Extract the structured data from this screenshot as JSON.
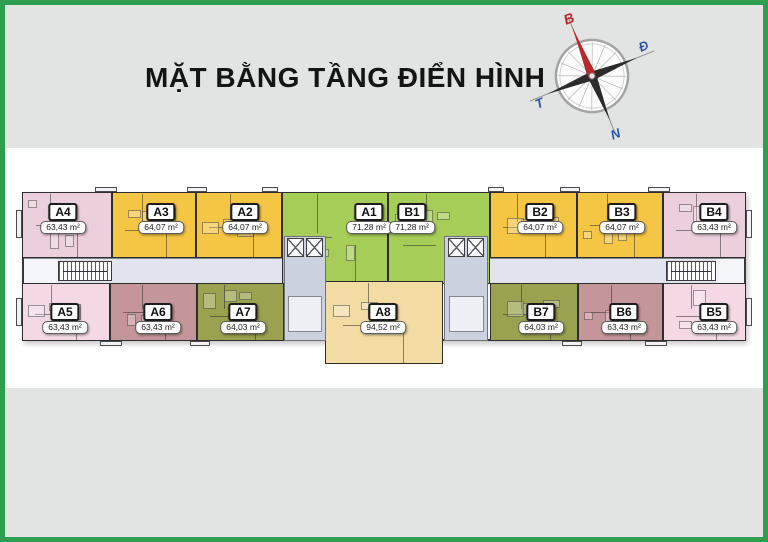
{
  "title": "MẶT BẰNG TẦNG ĐIỂN HÌNH",
  "compass": {
    "north": "B",
    "east": "Đ",
    "south": "N",
    "west": "T",
    "north_color": "#c0272d",
    "dir_color": "#2a55a5"
  },
  "palette": {
    "frame": "#2e9e50",
    "canvas": "#e2e4e3",
    "band": "#ffffff",
    "wall": "#383838",
    "yellow": "#f5c544",
    "green": "#a6cd58",
    "pink_top": "#ebcfdc",
    "pink_bottom": "#f4d9e4",
    "mauve": "#c49599",
    "olive": "#9aa14f",
    "tan": "#f3dba4",
    "corridor": "#e2e5f0",
    "core": "#ccd1df"
  },
  "floorplan": {
    "building": {
      "x": 22,
      "y": 192,
      "w": 724,
      "h": 149
    },
    "units": [
      {
        "code": "A4",
        "area": "63,43 m²",
        "color": "pink_top",
        "x": 22,
        "y": 192,
        "w": 90,
        "h": 66,
        "lx": 63,
        "row": "top"
      },
      {
        "code": "A3",
        "area": "64,07 m²",
        "color": "yellow",
        "x": 112,
        "y": 192,
        "w": 84,
        "h": 66,
        "lx": 161,
        "row": "top"
      },
      {
        "code": "A2",
        "area": "64,07 m²",
        "color": "yellow",
        "x": 196,
        "y": 192,
        "w": 86,
        "h": 66,
        "lx": 245,
        "row": "top"
      },
      {
        "code": "A1",
        "area": "71,28 m²",
        "color": "green",
        "x": 282,
        "y": 192,
        "w": 106,
        "h": 92,
        "lx": 369,
        "row": "top"
      },
      {
        "code": "B1",
        "area": "71,28 m²",
        "color": "green",
        "x": 388,
        "y": 192,
        "w": 102,
        "h": 92,
        "lx": 412,
        "row": "top"
      },
      {
        "code": "B2",
        "area": "64,07 m²",
        "color": "yellow",
        "x": 490,
        "y": 192,
        "w": 87,
        "h": 66,
        "lx": 540,
        "row": "top"
      },
      {
        "code": "B3",
        "area": "64,07 m²",
        "color": "yellow",
        "x": 577,
        "y": 192,
        "w": 86,
        "h": 66,
        "lx": 622,
        "row": "top"
      },
      {
        "code": "B4",
        "area": "63,43 m²",
        "color": "pink_top",
        "x": 663,
        "y": 192,
        "w": 83,
        "h": 66,
        "lx": 714,
        "row": "top"
      },
      {
        "code": "A5",
        "area": "63,43 m²",
        "color": "pink_bottom",
        "x": 22,
        "y": 283,
        "w": 88,
        "h": 58,
        "lx": 65,
        "row": "bottom"
      },
      {
        "code": "A6",
        "area": "63,43 m²",
        "color": "mauve",
        "x": 110,
        "y": 283,
        "w": 87,
        "h": 58,
        "lx": 158,
        "row": "bottom"
      },
      {
        "code": "A7",
        "area": "64,03 m²",
        "color": "olive",
        "x": 197,
        "y": 283,
        "w": 87,
        "h": 58,
        "lx": 243,
        "row": "bottom"
      },
      {
        "code": "B7",
        "area": "64,03 m²",
        "color": "olive",
        "x": 490,
        "y": 283,
        "w": 88,
        "h": 58,
        "lx": 541,
        "row": "bottom"
      },
      {
        "code": "B6",
        "area": "63,43 m²",
        "color": "mauve",
        "x": 578,
        "y": 283,
        "w": 85,
        "h": 58,
        "lx": 624,
        "row": "bottom"
      },
      {
        "code": "B5",
        "area": "63,43 m²",
        "color": "pink_bottom",
        "x": 663,
        "y": 283,
        "w": 83,
        "h": 58,
        "lx": 714,
        "row": "bottom"
      },
      {
        "code": "A8",
        "area": "94,52 m²",
        "color": "tan",
        "x": 325,
        "y": 281,
        "w": 118,
        "h": 83,
        "lx": 383,
        "row": "bottom"
      }
    ],
    "label_rows": {
      "top": {
        "code_y": 203,
        "area_y": 221
      },
      "bottom": {
        "code_y": 303,
        "area_y": 321
      }
    },
    "corridors": [
      {
        "x": 24,
        "y": 258,
        "w": 260,
        "h": 26
      },
      {
        "x": 488,
        "y": 258,
        "w": 256,
        "h": 26
      }
    ],
    "endcaps": [
      {
        "x": 24,
        "y": 259,
        "w": 34,
        "h": 24
      },
      {
        "x": 716,
        "y": 259,
        "w": 28,
        "h": 24
      }
    ],
    "stairs": [
      {
        "x": 58,
        "y": 261,
        "w": 54,
        "h": 20
      },
      {
        "x": 666,
        "y": 261,
        "w": 50,
        "h": 20
      }
    ],
    "lobbies": [
      {
        "x": 284,
        "y": 236,
        "w": 42,
        "h": 105
      },
      {
        "x": 444,
        "y": 236,
        "w": 44,
        "h": 105
      }
    ],
    "shafts": [
      {
        "x": 287,
        "y": 238,
        "w": 17,
        "h": 19
      },
      {
        "x": 306,
        "y": 238,
        "w": 17,
        "h": 19
      },
      {
        "x": 448,
        "y": 238,
        "w": 17,
        "h": 19
      },
      {
        "x": 467,
        "y": 238,
        "w": 17,
        "h": 19
      }
    ],
    "lobby_rooms": [
      {
        "x": 288,
        "y": 296,
        "w": 34,
        "h": 36
      },
      {
        "x": 449,
        "y": 296,
        "w": 35,
        "h": 36
      }
    ],
    "balconies": [
      {
        "x": 95,
        "y": 187,
        "w": 22,
        "h": 5
      },
      {
        "x": 187,
        "y": 187,
        "w": 20,
        "h": 5
      },
      {
        "x": 262,
        "y": 187,
        "w": 16,
        "h": 5
      },
      {
        "x": 488,
        "y": 187,
        "w": 16,
        "h": 5
      },
      {
        "x": 560,
        "y": 187,
        "w": 20,
        "h": 5
      },
      {
        "x": 648,
        "y": 187,
        "w": 22,
        "h": 5
      },
      {
        "x": 16,
        "y": 210,
        "w": 6,
        "h": 28
      },
      {
        "x": 746,
        "y": 210,
        "w": 6,
        "h": 28
      },
      {
        "x": 16,
        "y": 298,
        "w": 6,
        "h": 28
      },
      {
        "x": 746,
        "y": 298,
        "w": 6,
        "h": 28
      },
      {
        "x": 100,
        "y": 341,
        "w": 22,
        "h": 5
      },
      {
        "x": 190,
        "y": 341,
        "w": 20,
        "h": 5
      },
      {
        "x": 562,
        "y": 341,
        "w": 20,
        "h": 5
      },
      {
        "x": 645,
        "y": 341,
        "w": 22,
        "h": 5
      }
    ]
  }
}
